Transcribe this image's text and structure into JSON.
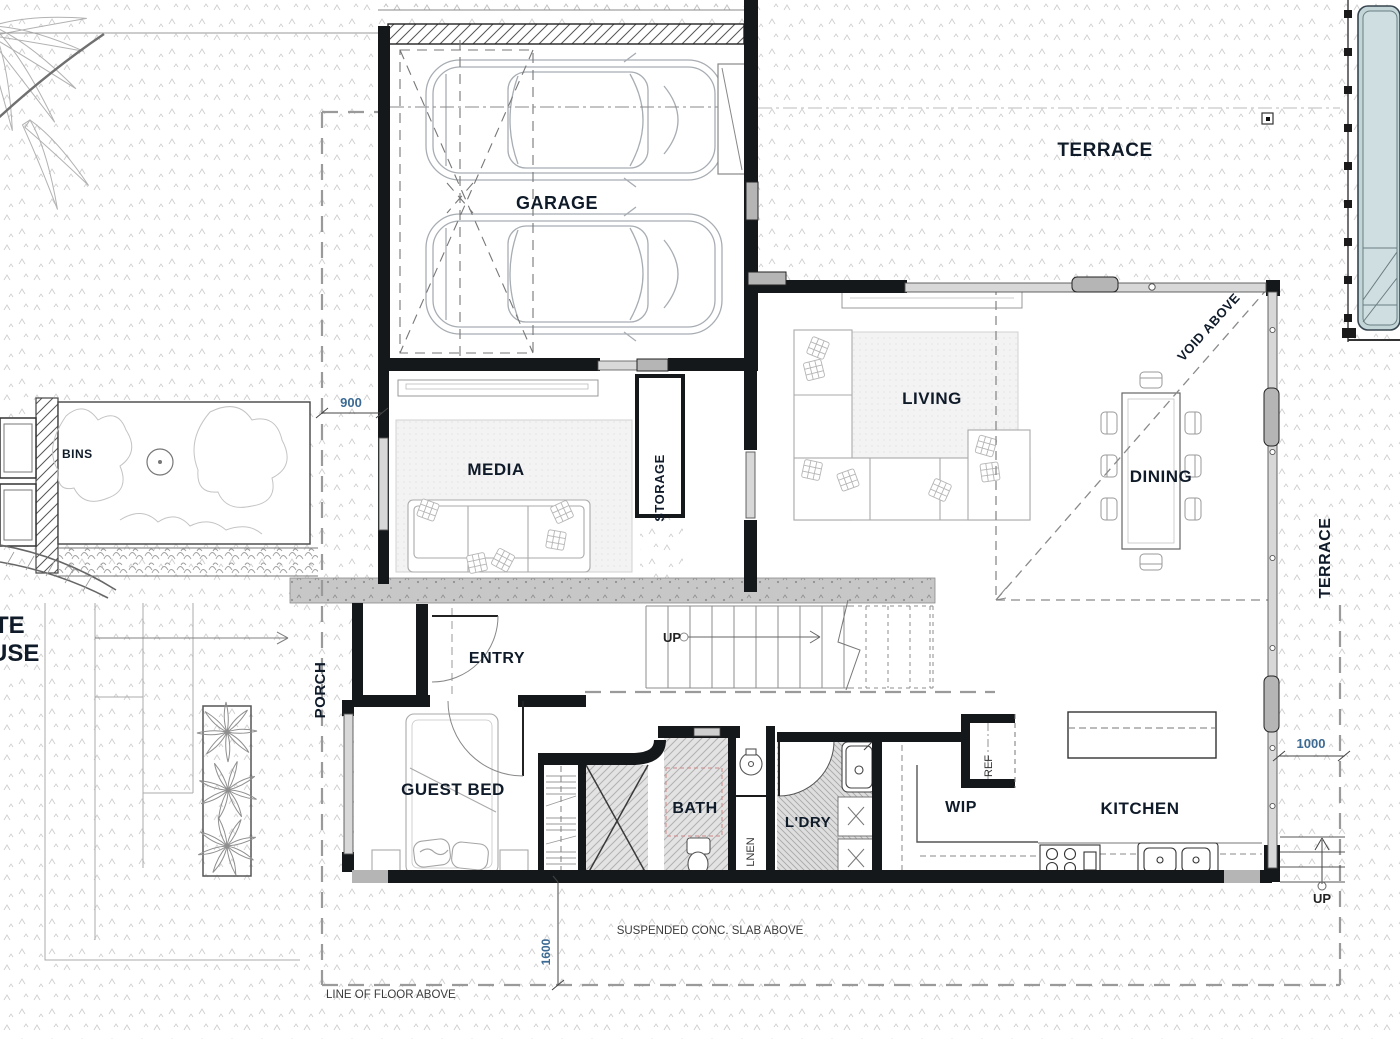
{
  "rooms": {
    "garage": "GARAGE",
    "terrace_upper": "TERRACE",
    "terrace_east": "TERRACE",
    "media": "MEDIA",
    "storage": "STORAGE",
    "living": "LIVING",
    "dining": "DINING",
    "entry": "ENTRY",
    "porch": "PORCH",
    "guest_bed": "GUEST BED",
    "bath": "BATH",
    "laundry": "L'DRY",
    "linen": "LNEN",
    "wip": "WIP",
    "ref": "REF",
    "kitchen": "KITCHEN",
    "bins": "BINS"
  },
  "stairs": {
    "up_label": "UP"
  },
  "exterior": {
    "up_label": "UP",
    "neighbour_text_line1": "TE",
    "neighbour_text_line2": "USE"
  },
  "annotations": {
    "void_above": "VOID ABOVE",
    "suspended_slab": "SUSPENDED CONC. SLAB ABOVE",
    "line_of_floor": "LINE OF FLOOR ABOVE"
  },
  "dimensions": {
    "media_offset": "900",
    "kitchen_offset": "1000",
    "slab_offset": "1600"
  },
  "colors": {
    "wall": "#15181a",
    "glazing_fill": "#d8d8d8",
    "slab_gray": "#c7c7c7",
    "pool_water": "#c3d5d7",
    "room_label": "#101b2a",
    "dimension_text": "#3c6a93",
    "linework": "#9c9c9c",
    "hatch": "#b3b3b3"
  }
}
